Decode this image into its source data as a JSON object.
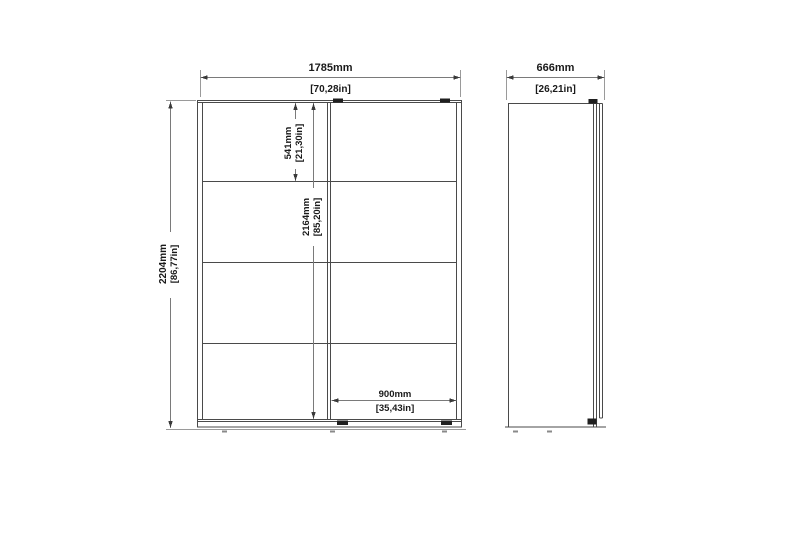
{
  "drawing": {
    "type": "furniture-dimension-drawing",
    "views": {
      "front": "wardrobe-front-elevation",
      "side": "wardrobe-side-elevation"
    },
    "dimensions": {
      "front_width": {
        "mm": "1785mm",
        "in": "[70,28in]"
      },
      "front_height": {
        "mm": "2204mm",
        "in": "[86,77in]"
      },
      "top_section_height": {
        "mm": "541mm",
        "in": "[21,30in]"
      },
      "interior_height": {
        "mm": "2164mm",
        "in": "[85,20in]"
      },
      "right_section_width": {
        "mm": "900mm",
        "in": "[35,43in]"
      },
      "side_depth": {
        "mm": "666mm",
        "in": "[26,21in]"
      }
    },
    "colors": {
      "outline": "#4a4a4a",
      "dim_line": "#7a7a7a",
      "extension_line": "#9a9a9a",
      "hardware": "#1f1f1f",
      "text": "#1a1a1a",
      "background": "#ffffff"
    }
  }
}
